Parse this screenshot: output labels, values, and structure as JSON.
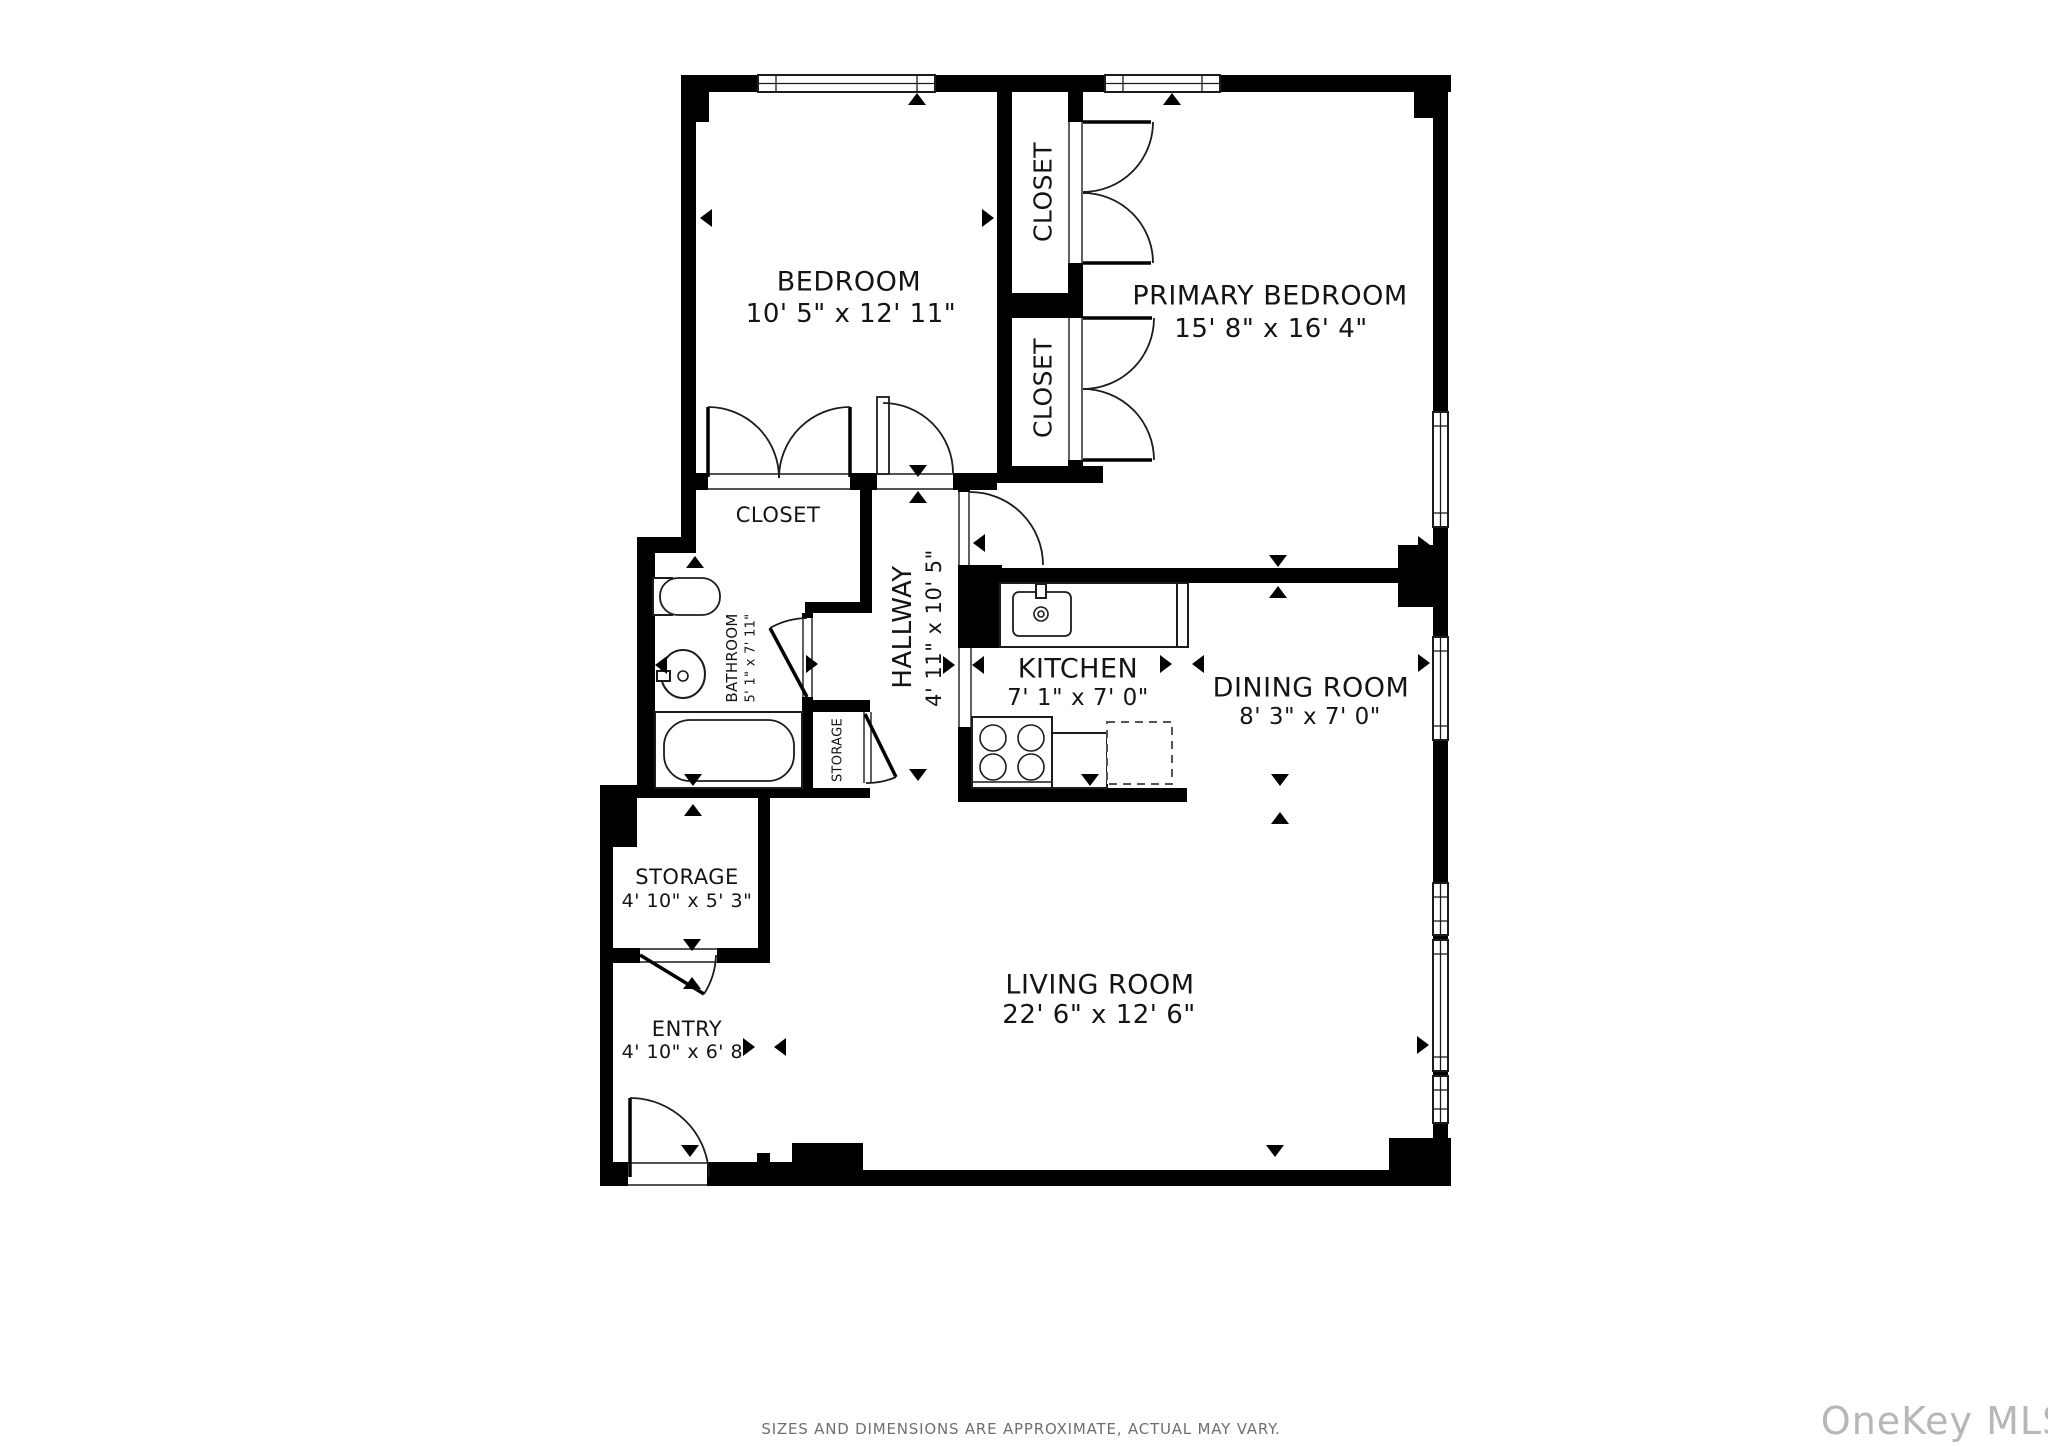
{
  "page": {
    "background": "#ffffff",
    "wall_color": "#000000",
    "line_color": "#1c1c1c"
  },
  "footer": {
    "disclaimer": "SIZES AND DIMENSIONS ARE APPROXIMATE, ACTUAL MAY VARY."
  },
  "watermark": {
    "text": "OneKey MLS",
    "color": "#b7b7bb"
  },
  "floorplan": {
    "rooms": [
      {
        "id": "bedroom",
        "name": "BEDROOM",
        "dims": "10' 5\" x 12' 11\""
      },
      {
        "id": "primary-bedroom",
        "name": "PRIMARY BEDROOM",
        "dims": "15' 8\" x 16' 4\""
      },
      {
        "id": "closet-1",
        "name": "CLOSET",
        "dims": ""
      },
      {
        "id": "closet-2",
        "name": "CLOSET",
        "dims": ""
      },
      {
        "id": "closet-hall",
        "name": "CLOSET",
        "dims": ""
      },
      {
        "id": "hallway",
        "name": "HALLWAY",
        "dims": "4' 11\" x 10' 5\""
      },
      {
        "id": "bathroom",
        "name": "BATHROOM",
        "dims": "5' 1\" x 7' 11\""
      },
      {
        "id": "storage-closet",
        "name": "STORAGE",
        "dims": ""
      },
      {
        "id": "kitchen",
        "name": "KITCHEN",
        "dims": "7' 1\" x 7' 0\""
      },
      {
        "id": "dining-room",
        "name": "DINING ROOM",
        "dims": "8' 3\" x 7' 0\""
      },
      {
        "id": "storage",
        "name": "STORAGE",
        "dims": "4' 10\" x 5' 3\""
      },
      {
        "id": "entry",
        "name": "ENTRY",
        "dims": "4' 10\" x 6' 8\""
      },
      {
        "id": "living-room",
        "name": "LIVING ROOM",
        "dims": "22' 6\" x 12' 6\""
      }
    ],
    "geometry": {
      "walls": [
        [
          681,
          75,
          770,
          17
        ],
        [
          696,
          92,
          13,
          30
        ],
        [
          1414,
          92,
          19,
          26
        ],
        [
          681,
          92,
          15,
          445
        ],
        [
          637,
          537,
          59,
          16
        ],
        [
          637,
          553,
          18,
          235
        ],
        [
          637,
          788,
          233,
          10
        ],
        [
          600,
          785,
          37,
          62
        ],
        [
          600,
          847,
          13,
          339
        ],
        [
          758,
          798,
          12,
          165
        ],
        [
          613,
          948,
          27,
          15
        ],
        [
          717,
          948,
          53,
          15
        ],
        [
          997,
          92,
          15,
          381
        ],
        [
          1068,
          92,
          15,
          30
        ],
        [
          1068,
          263,
          15,
          55
        ],
        [
          1068,
          460,
          15,
          23
        ],
        [
          1012,
          293,
          56,
          25
        ],
        [
          681,
          473,
          27,
          17
        ],
        [
          850,
          473,
          27,
          17
        ],
        [
          953,
          473,
          44,
          17
        ],
        [
          997,
          466,
          106,
          17
        ],
        [
          958,
          483,
          12,
          9
        ],
        [
          970,
          568,
          428,
          15
        ],
        [
          1398,
          545,
          36,
          62
        ],
        [
          958,
          565,
          44,
          83
        ],
        [
          958,
          727,
          14,
          71
        ],
        [
          958,
          788,
          229,
          14
        ],
        [
          860,
          483,
          12,
          119
        ],
        [
          805,
          602,
          67,
          11
        ],
        [
          802,
          613,
          11,
          5
        ],
        [
          802,
          697,
          11,
          101
        ],
        [
          805,
          700,
          65,
          12
        ],
        [
          1433,
          92,
          15,
          320
        ],
        [
          1433,
          527,
          15,
          110
        ],
        [
          1433,
          740,
          15,
          143
        ],
        [
          1433,
          935,
          15,
          5
        ],
        [
          1433,
          1071,
          15,
          5
        ],
        [
          1433,
          1123,
          15,
          63
        ],
        [
          1389,
          1138,
          62,
          48
        ],
        [
          600,
          1162,
          28,
          24
        ],
        [
          707,
          1162,
          85,
          24
        ],
        [
          792,
          1143,
          71,
          43
        ],
        [
          863,
          1170,
          526,
          16
        ],
        [
          757,
          1153,
          13,
          17
        ]
      ],
      "windows": [
        [
          758,
          75,
          177,
          17,
          "h"
        ],
        [
          1105,
          75,
          115,
          17,
          "h"
        ],
        [
          1433,
          412,
          15,
          115,
          "v"
        ],
        [
          1433,
          637,
          15,
          103,
          "v"
        ],
        [
          1433,
          883,
          15,
          52,
          "v"
        ],
        [
          1433,
          940,
          15,
          131,
          "v"
        ],
        [
          1433,
          1076,
          15,
          47,
          "v"
        ]
      ],
      "openings": [
        [
          708,
          473,
          142,
          17,
          "h"
        ],
        [
          877,
          473,
          76,
          17,
          "h"
        ],
        [
          958,
          492,
          12,
          73,
          "v"
        ],
        [
          958,
          648,
          14,
          79,
          "v"
        ],
        [
          802,
          618,
          11,
          79,
          "v"
        ],
        [
          1068,
          122,
          15,
          141,
          "v"
        ],
        [
          1068,
          318,
          15,
          142,
          "v"
        ],
        [
          640,
          948,
          77,
          15,
          "h"
        ],
        [
          863,
          712,
          9,
          71,
          "v"
        ],
        [
          628,
          1162,
          79,
          24,
          "h"
        ]
      ],
      "arcs": [
        "M708 407 A71 71 0 0 1 779 478",
        "M850 407 A71 71 0 0 0 779 478",
        "M883 403 A70 70 0 0 1 953 473",
        "M970 492 A73 73 0 0 1 1043 565",
        "M1153 122 A70 70 0 0 1 1083 192",
        "M1153 263 A70 70 0 0 0 1083 193",
        "M1154 318 A71 71 0 0 1 1083 389",
        "M1154 460 A71 71 0 0 0 1083 389",
        "M770 628 A79 79 0 0 1 807 618",
        "M704 994 A76 76 0 0 0 716 955",
        "M896 777 A70 70 0 0 1 866 783",
        "M630 1098 A79 79 0 0 1 709 1177"
      ],
      "leaf_lines": [
        [
          708,
          407,
          708,
          477
        ],
        [
          850,
          407,
          850,
          477
        ],
        [
          1083,
          122,
          1151,
          122
        ],
        [
          1083,
          263,
          1151,
          263
        ],
        [
          1083,
          318,
          1152,
          318
        ],
        [
          1083,
          460,
          1152,
          460
        ],
        [
          807,
          697,
          770,
          628
        ],
        [
          640,
          955,
          704,
          994
        ],
        [
          865,
          714,
          896,
          777
        ],
        [
          630,
          1098,
          630,
          1177
        ]
      ],
      "leaf_rects": [
        [
          877,
          397,
          12,
          77
        ]
      ],
      "fixtures": [
        {
          "n": "bathtub",
          "t": "rect",
          "v": [
            655,
            712,
            147,
            76
          ]
        },
        {
          "n": "bathtub-basin",
          "t": "rrect",
          "v": [
            664,
            720,
            130,
            61,
            26
          ]
        },
        {
          "n": "toilet-tank",
          "t": "rect",
          "v": [
            653,
            578,
            19,
            37
          ]
        },
        {
          "n": "toilet-bowl",
          "t": "rrect",
          "v": [
            660,
            578,
            60,
            37,
            18
          ]
        },
        {
          "n": "bathroom-sink",
          "t": "ellipse",
          "v": [
            683,
            674,
            22,
            24
          ]
        },
        {
          "n": "bathroom-faucet",
          "t": "rect",
          "v": [
            657,
            671,
            13,
            10
          ]
        },
        {
          "n": "bathroom-drain",
          "t": "circle",
          "v": [
            683,
            676,
            5
          ]
        },
        {
          "n": "kitchen-counter",
          "t": "rect",
          "v": [
            1000,
            583,
            178,
            64
          ]
        },
        {
          "n": "kitchen-sink",
          "t": "rrect",
          "v": [
            1013,
            592,
            58,
            44,
            6
          ]
        },
        {
          "n": "kitchen-faucet",
          "t": "rect",
          "v": [
            1036,
            584,
            10,
            14
          ]
        },
        {
          "n": "kitchen-drain",
          "t": "circle",
          "v": [
            1041,
            614,
            7
          ]
        },
        {
          "n": "kitchen-drain-dot",
          "t": "circle",
          "v": [
            1041,
            614,
            3
          ]
        },
        {
          "n": "counter-end",
          "t": "rect",
          "v": [
            1177,
            583,
            11,
            64
          ]
        },
        {
          "n": "stove",
          "t": "rect",
          "v": [
            972,
            717,
            80,
            71
          ]
        },
        {
          "n": "burner",
          "t": "circle",
          "v": [
            993,
            738,
            13
          ]
        },
        {
          "n": "burner",
          "t": "circle",
          "v": [
            1031,
            738,
            13
          ]
        },
        {
          "n": "burner",
          "t": "circle",
          "v": [
            993,
            767,
            13
          ]
        },
        {
          "n": "burner",
          "t": "circle",
          "v": [
            1031,
            767,
            13
          ]
        },
        {
          "n": "stove-edge",
          "t": "line",
          "v": [
            972,
            782,
            1052,
            782
          ]
        },
        {
          "n": "kitchen-counter-2",
          "t": "rect",
          "v": [
            1052,
            733,
            55,
            55
          ]
        },
        {
          "n": "dishwasher",
          "t": "drect",
          "v": [
            1107,
            722,
            65,
            62
          ]
        }
      ],
      "markers": [
        [
          917,
          93,
          "up"
        ],
        [
          1172,
          93,
          "up"
        ],
        [
          700,
          218,
          "left"
        ],
        [
          994,
          218,
          "right"
        ],
        [
          918,
          477,
          "down"
        ],
        [
          918,
          491,
          "up"
        ],
        [
          973,
          543,
          "left"
        ],
        [
          695,
          556,
          "up"
        ],
        [
          655,
          665,
          "left"
        ],
        [
          818,
          664,
          "right"
        ],
        [
          1278,
          567,
          "down"
        ],
        [
          1278,
          586,
          "up"
        ],
        [
          1430,
          545,
          "right"
        ],
        [
          955,
          665,
          "right"
        ],
        [
          972,
          665,
          "left"
        ],
        [
          1172,
          664,
          "right"
        ],
        [
          1192,
          664,
          "left"
        ],
        [
          1090,
          786,
          "down"
        ],
        [
          918,
          781,
          "down"
        ],
        [
          1430,
          663,
          "right"
        ],
        [
          1280,
          786,
          "down"
        ],
        [
          1280,
          812,
          "up"
        ],
        [
          692,
          951,
          "down"
        ],
        [
          692,
          977,
          "up"
        ],
        [
          600,
          1048,
          "left"
        ],
        [
          755,
          1047,
          "right"
        ],
        [
          774,
          1047,
          "left"
        ],
        [
          690,
          1157,
          "down"
        ],
        [
          1429,
          1045,
          "right"
        ],
        [
          1275,
          1157,
          "down"
        ],
        [
          693,
          786,
          "down"
        ],
        [
          693,
          804,
          "up"
        ]
      ]
    }
  }
}
